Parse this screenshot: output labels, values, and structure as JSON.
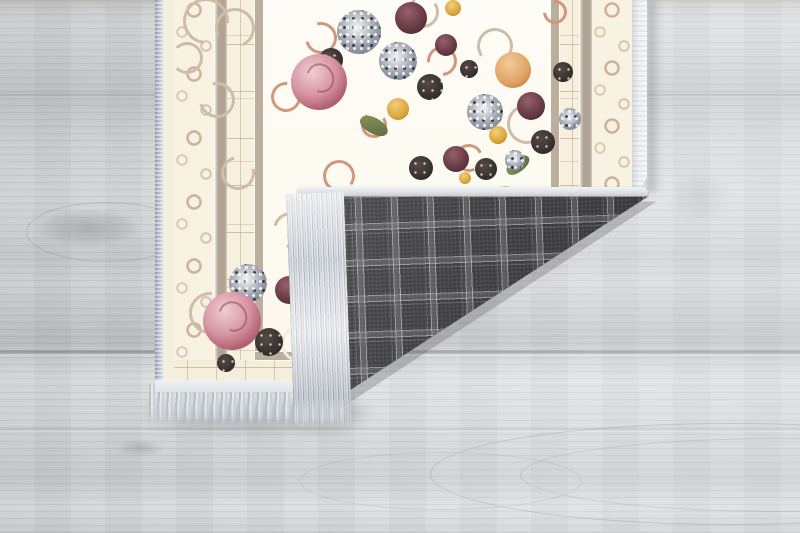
{
  "scene": {
    "type": "product-photo",
    "description": "Cream baroque floral area rug with its bottom-right corner folded over, revealing a dark gray plaid woven backing with silver-gray fringe, lying on a light gray wood plank floor",
    "floor": {
      "material": "wood-planks",
      "grain_orientation": "horizontal"
    },
    "rug": {
      "front_style": "ivory field, baroque copper scrollwork, pink and plum rose bouquets, taupe border bands with scroll vine",
      "back_style": "charcoal tartan plaid weave",
      "fringe": "silver-gray tassels on short ends",
      "fold": "bottom-right corner folded up toward upper-left"
    }
  },
  "colors": {
    "floor_base": "#d6d7d9",
    "rug_field": "#fbf7ec",
    "rug_margin": "#f4eedd",
    "rug_band": "#b1a494",
    "rug_frame": "#bcae9d",
    "scroll_pale": "#cdbda9",
    "copper": "#d2967c",
    "rose_pink": "#d795a3",
    "plum": "#5f3540",
    "cluster_gray": "#9aa0ab",
    "foliage_dark": "#332e2b",
    "flower_yellow": "#d9a53a",
    "flower_orange": "#dfa263",
    "leaf_green": "#5a683d",
    "plaid_base": "#474749",
    "fringe_light": "#e6e9ec",
    "fringe_mid": "#b9bfc7",
    "selvedge_blue": "#95a0b3"
  }
}
